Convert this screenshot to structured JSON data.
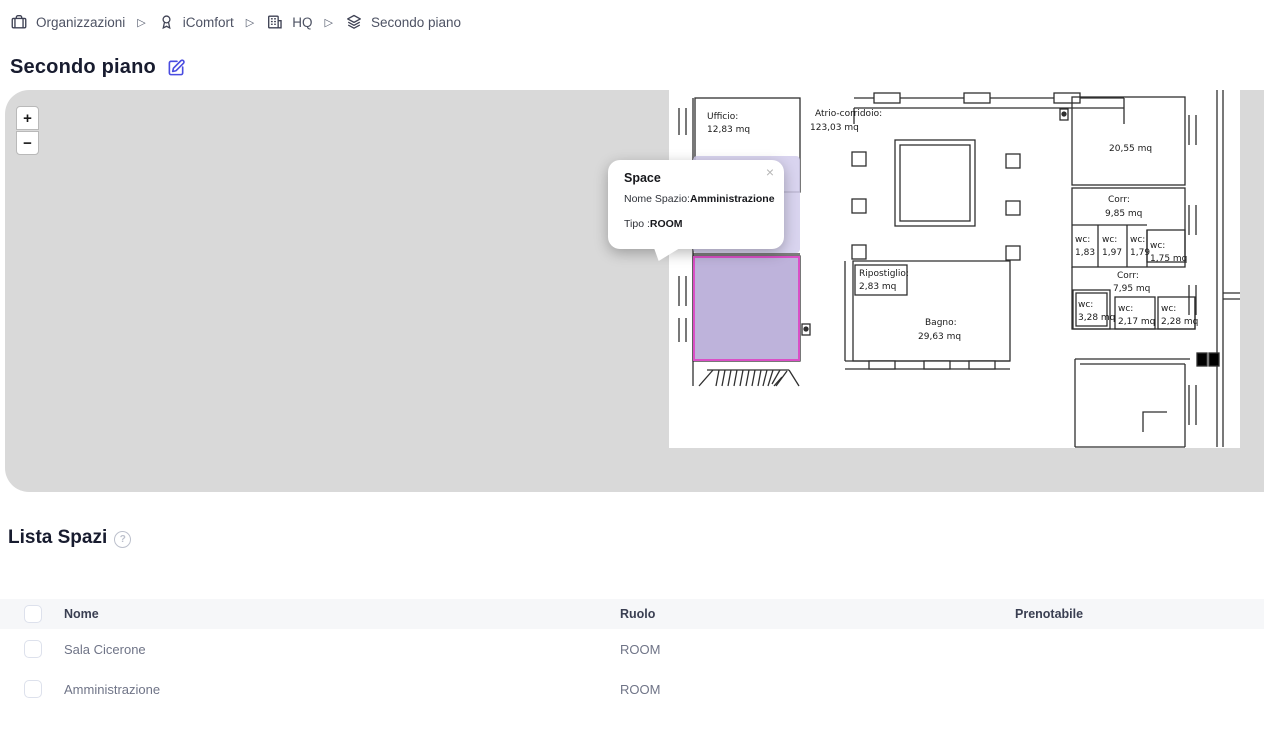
{
  "breadcrumb": {
    "separator": "▷",
    "items": [
      {
        "label": "Organizzazioni",
        "icon": "organization-icon"
      },
      {
        "label": "iComfort",
        "icon": "award-icon"
      },
      {
        "label": "HQ",
        "icon": "building-icon"
      },
      {
        "label": "Secondo piano",
        "icon": "layers-icon"
      }
    ]
  },
  "page": {
    "title": "Secondo piano"
  },
  "map": {
    "zoom_in": "+",
    "zoom_out": "−",
    "tooltip": {
      "title": "Space",
      "close": "×",
      "name_label": "Nome Spazio:",
      "name_value": "Amministrazione",
      "type_label": "Tipo :",
      "type_value": "ROOM"
    },
    "selected_space": {
      "name": "Amministrazione",
      "fill": "#b5a8d6",
      "border": "#da4fc6"
    },
    "hover_fill": "#d2ccec",
    "plan": {
      "ufficio": {
        "n": "Ufficio:",
        "a": "12,83 mq"
      },
      "atrio": {
        "n": "Atrio-corridoio:",
        "a": "123,03 mq"
      },
      "room2055": {
        "a": "20,55 mq"
      },
      "corr985": {
        "n": "Corr:",
        "a": "9,85 mq"
      },
      "wc183": {
        "n": "wc:",
        "a": "1,83"
      },
      "wc197": {
        "n": "wc:",
        "a": "1,97"
      },
      "wc179": {
        "n": "wc:",
        "a": "1,79"
      },
      "wc175": {
        "n": "wc:",
        "a": "1,75 mq"
      },
      "corr795": {
        "n": "Corr:",
        "a": "7,95 mq"
      },
      "wc328": {
        "n": "wc:",
        "a": "3,28 mq"
      },
      "wc217": {
        "n": "wc:",
        "a": "2,17 mq"
      },
      "wc228": {
        "n": "wc:",
        "a": "2,28 mq"
      },
      "ripostiglio": {
        "n": "Ripostiglio:",
        "a": "2,83 mq"
      },
      "bagno": {
        "n": "Bagno:",
        "a": "29,63 mq"
      }
    }
  },
  "list": {
    "title": "Lista Spazi",
    "help": "?",
    "columns": {
      "nome": "Nome",
      "ruolo": "Ruolo",
      "prenotabile": "Prenotabile"
    },
    "rows": [
      {
        "nome": "Sala Cicerone",
        "ruolo": "ROOM",
        "prenotabile": ""
      },
      {
        "nome": "Amministrazione",
        "ruolo": "ROOM",
        "prenotabile": ""
      }
    ]
  }
}
